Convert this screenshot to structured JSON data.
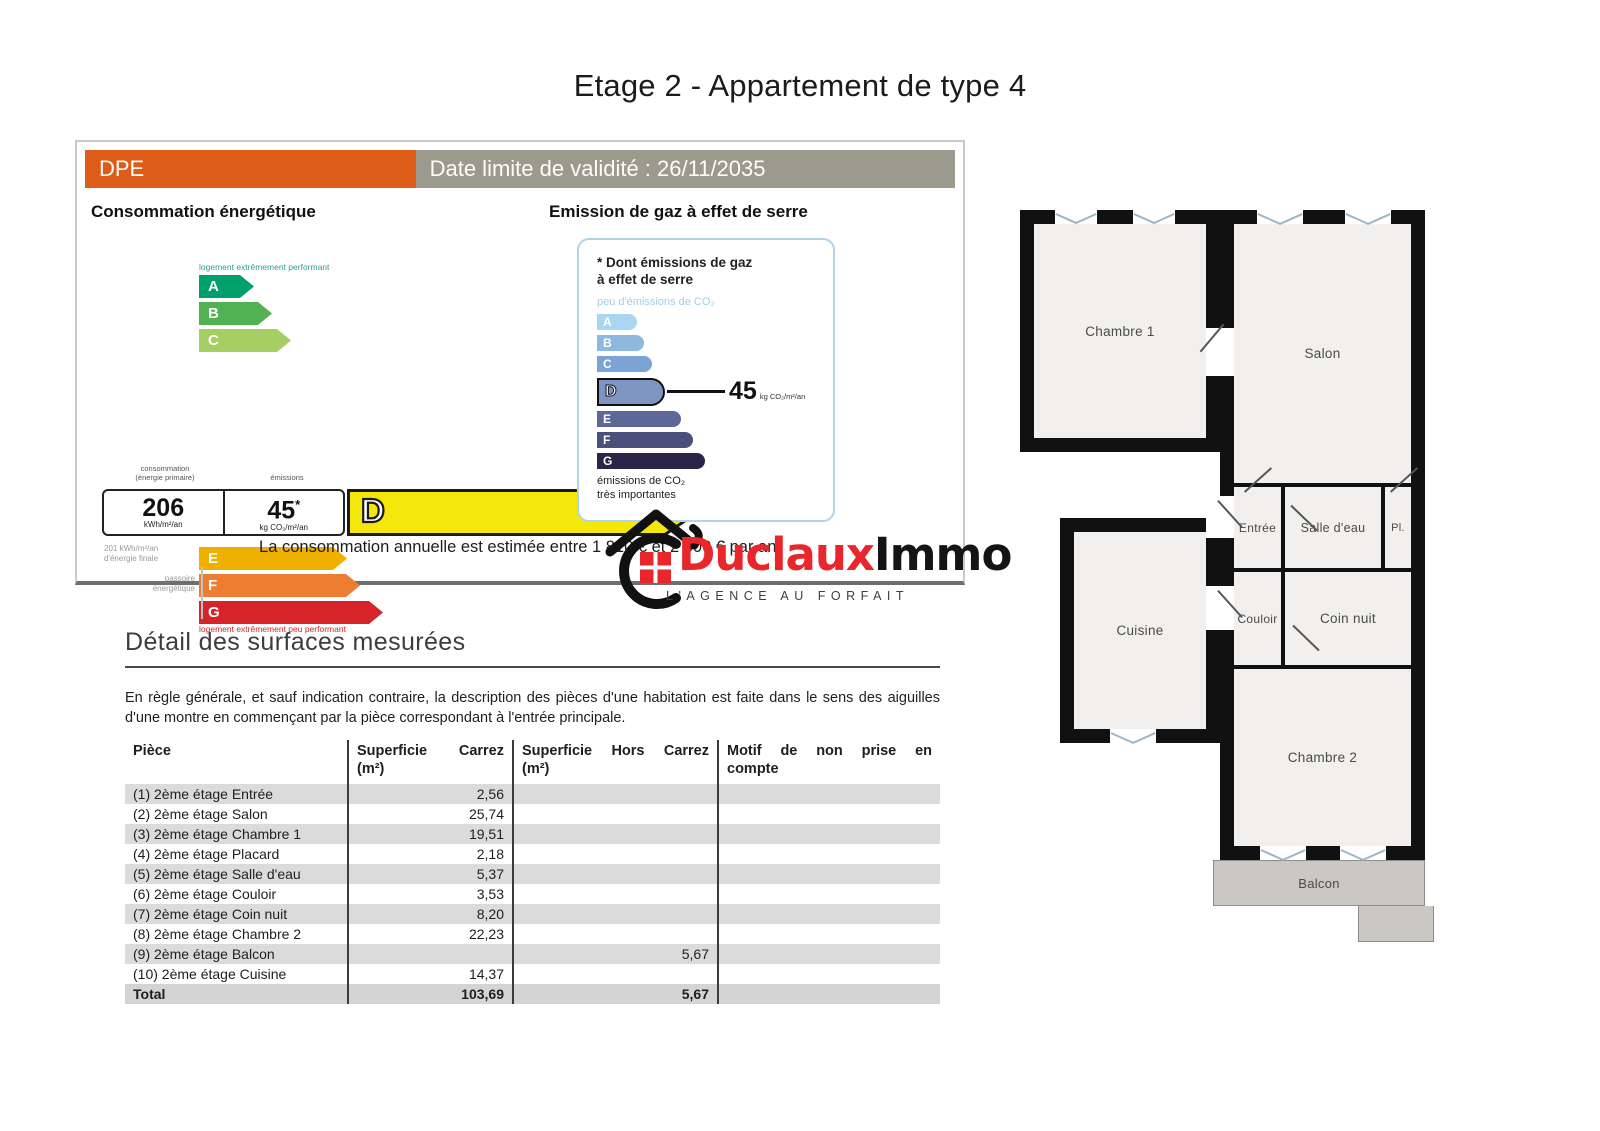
{
  "page_title": "Etage 2 - Appartement de type 4",
  "dpe": {
    "label": "DPE",
    "validity": "Date limite de validité : 26/11/2035",
    "energy_title": "Consommation énergétique",
    "gas_title": "Emission de gaz à effet de serre",
    "top_caption": "logement extrêmement performant",
    "bottom_caption": "logement extrêmement peu performant",
    "left_label_consumption": "consommation",
    "left_label_consumption_sub": "(énergie primaire)",
    "left_label_emissions": "émissions",
    "rating_letter": "D",
    "energy_value": "206",
    "energy_unit": "kWh/m²/an",
    "co2_value": "45",
    "co2_star": "*",
    "co2_unit": "kg CO₂/m²/an",
    "final_energy_note_1": "201 kWh/m²/an",
    "final_energy_note_2": "d'énergie finale",
    "sieve_label_1": "passoire",
    "sieve_label_2": "énergétique",
    "energy_bars": [
      {
        "letter": "A",
        "color": "#00a06d",
        "w": 55,
        "y": 0
      },
      {
        "letter": "B",
        "color": "#52b153",
        "w": 73,
        "y": 27
      },
      {
        "letter": "C",
        "color": "#a5cf63",
        "w": 92,
        "y": 54
      },
      {
        "letter": "E",
        "color": "#efb000",
        "w": 148,
        "y": 272
      },
      {
        "letter": "F",
        "color": "#ed7d31",
        "w": 161,
        "y": 299
      },
      {
        "letter": "G",
        "color": "#d7232a",
        "w": 184,
        "y": 326
      }
    ],
    "rating_color": "#f3e70c",
    "gas_box": {
      "title_1": "* Dont émissions de gaz",
      "title_2": "à effet de serre",
      "low_caption": "peu d'émissions de CO₂",
      "high_caption_1": "émissions de CO₂",
      "high_caption_2": "très importantes",
      "value": "45",
      "unit": "kg CO₂/m²/an",
      "bars": [
        {
          "letter": "A",
          "color": "#a9d7f2",
          "w": 40
        },
        {
          "letter": "B",
          "color": "#8fb8e0",
          "w": 47
        },
        {
          "letter": "C",
          "color": "#7ba3d4",
          "w": 55
        },
        {
          "letter": "D",
          "color": "#7e95c1",
          "w": 68,
          "featured": true
        },
        {
          "letter": "E",
          "color": "#5d6899",
          "w": 84
        },
        {
          "letter": "F",
          "color": "#4a4f7c",
          "w": 96
        },
        {
          "letter": "G",
          "color": "#2b2547",
          "w": 108
        }
      ]
    },
    "estimate": "La consommation annuelle est estimée entre 1 810 € et 2 500 € par an."
  },
  "logo": {
    "brand_red": "Duclaux",
    "brand_black": "Immo",
    "tagline": "L'AGENCE AU FORFAIT"
  },
  "surfaces": {
    "title": "Détail des surfaces mesurées",
    "intro": "En règle générale, et sauf indication contraire, la description des pièces d'une habitation est faite dans le sens des aiguilles d'une montre en commençant par la pièce correspondant à l'entrée principale.",
    "columns": [
      {
        "l1": "Pièce",
        "l2": ""
      },
      {
        "l1": "Superficie Carrez",
        "l2": "(m²)"
      },
      {
        "l1": "Superficie Hors Carrez",
        "l2": "(m²)"
      },
      {
        "l1": "Motif de non prise en",
        "l2": "compte"
      }
    ],
    "rows": [
      {
        "piece": "(1) 2ème étage Entrée",
        "carrez": "2,56",
        "hors": "",
        "motif": ""
      },
      {
        "piece": "(2) 2ème étage Salon",
        "carrez": "25,74",
        "hors": "",
        "motif": ""
      },
      {
        "piece": "(3) 2ème étage Chambre 1",
        "carrez": "19,51",
        "hors": "",
        "motif": ""
      },
      {
        "piece": "(4) 2ème étage Placard",
        "carrez": "2,18",
        "hors": "",
        "motif": ""
      },
      {
        "piece": "(5) 2ème étage Salle d'eau",
        "carrez": "5,37",
        "hors": "",
        "motif": ""
      },
      {
        "piece": "(6) 2ème étage Couloir",
        "carrez": "3,53",
        "hors": "",
        "motif": ""
      },
      {
        "piece": "(7) 2ème étage Coin nuit",
        "carrez": "8,20",
        "hors": "",
        "motif": ""
      },
      {
        "piece": "(8) 2ème étage Chambre 2",
        "carrez": "22,23",
        "hors": "",
        "motif": ""
      },
      {
        "piece": "(9) 2ème étage Balcon",
        "carrez": "",
        "hors": "5,67",
        "motif": ""
      },
      {
        "piece": "(10) 2ème étage Cuisine",
        "carrez": "14,37",
        "hors": "",
        "motif": ""
      },
      {
        "piece": "Total",
        "carrez": "103,69",
        "hors": "5,67",
        "motif": "",
        "total": true
      }
    ]
  },
  "floorplan": {
    "rooms": {
      "chambre1": "Chambre 1",
      "salon": "Salon",
      "entree": "Entrée",
      "salledeau": "Salle d'eau",
      "pl": "Pl.",
      "cuisine": "Cuisine",
      "couloir": "Couloir",
      "coinnuit": "Coin nuit",
      "chambre2": "Chambre 2",
      "balcon": "Balcon"
    }
  }
}
